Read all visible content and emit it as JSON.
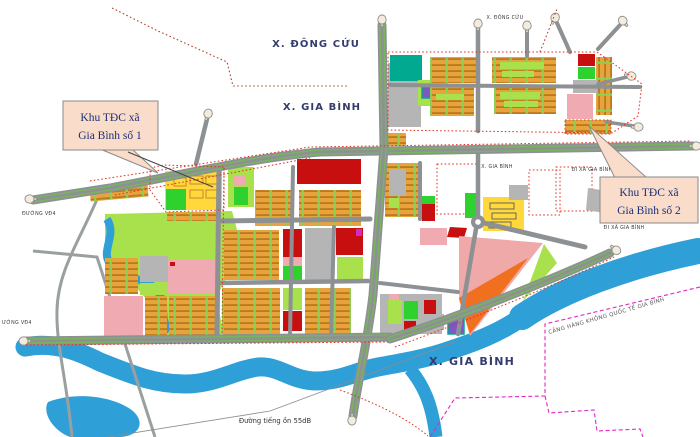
{
  "map": {
    "region_labels": {
      "dong_cuu_top": "X. ĐÔNG CỨU",
      "gia_binh_upper": "X. GIA BÌNH",
      "dong_cuu_small": "X. ĐÔNG CỨU",
      "gia_binh_small": "X. GIA BÌNH",
      "gia_binh_bottom": "X. GIA BÌNH"
    },
    "road_labels": {
      "di_xa_gia_binh_upper": "ĐI XÃ GIA BÌNH",
      "di_xa_gia_binh_lower": "ĐI XÃ GIA BÌNH",
      "duong_vd4_upper": "ĐƯỜNG VĐ4",
      "duong_vd4_lower": "ƯỜNG VĐ4",
      "noise_line": "Đường tiếng ồn 55dB",
      "airport_boundary": "CẢNG HÀNG KHÔNG QUỐC TẾ GIA BÌNH"
    },
    "callouts": {
      "site1": {
        "line1": "Khu TĐC xã",
        "line2": "Gia Bình số 1"
      },
      "site2": {
        "line1": "Khu TĐC xã",
        "line2": "Gia Bình số 2"
      }
    },
    "colors": {
      "water": "#2f9fd8",
      "park": "#a9e14d",
      "residential_lot": "#e8a43c",
      "lot_stripe": "#b9791e",
      "red_block": "#c80f0f",
      "pink_block": "#efaab2",
      "gray_block": "#b5b5b5",
      "yellow_block": "#ffd93b",
      "green_space": "#2fd12f",
      "teal_block": "#00a98f",
      "purple_block": "#7e57c2",
      "orange_block": "#f07020",
      "road": "#8d9194",
      "road_stripe": "#79b55c",
      "plan_boundary_dotted": "#e03020",
      "airport_boundary_dashed": "#e326c4",
      "callout_bg": "#f9dcc9",
      "label_navy": "#323c6e"
    }
  }
}
